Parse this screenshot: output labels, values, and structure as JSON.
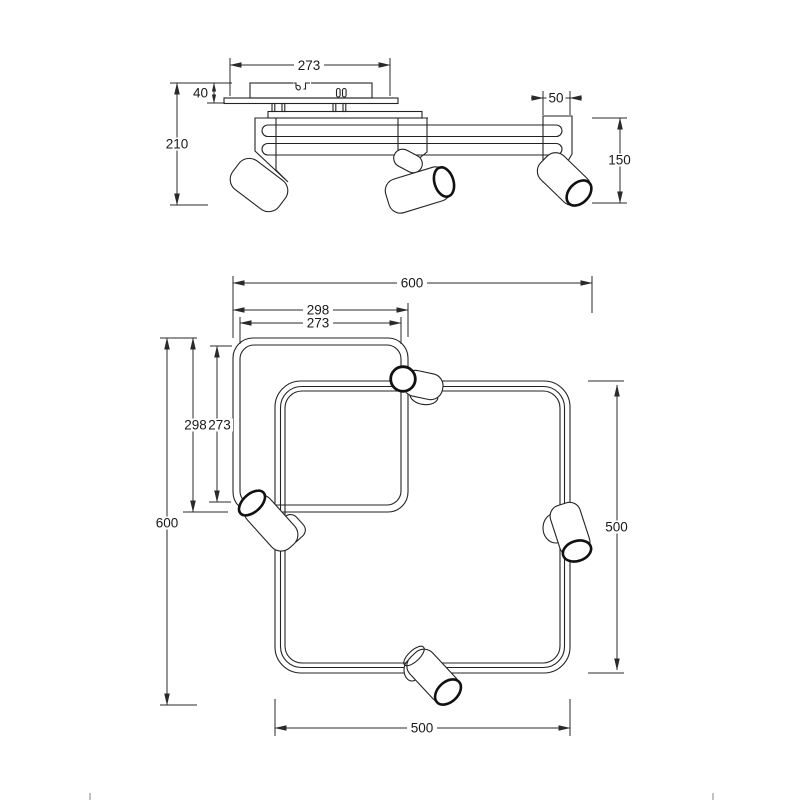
{
  "page": {
    "background": "#ffffff",
    "line_color": "#232323",
    "description": "Technical dimension drawing of a 4-spot ceiling light with two overlapping square frame tubes"
  },
  "side_view": {
    "name": "side-elevation",
    "dimensions": {
      "canopy_width": "273",
      "canopy_height": "40",
      "overall_height": "210",
      "end_profile_width": "50",
      "spot_drop_height": "150"
    }
  },
  "top_view": {
    "name": "plan-view",
    "dimensions": {
      "overall_width": "600",
      "overall_height": "600",
      "inner_frame_outer_width": "298",
      "inner_frame_inner_width": "273",
      "inner_frame_outer_height": "298",
      "inner_frame_inner_height": "273",
      "outer_frame_width": "500",
      "outer_frame_height": "500"
    }
  }
}
